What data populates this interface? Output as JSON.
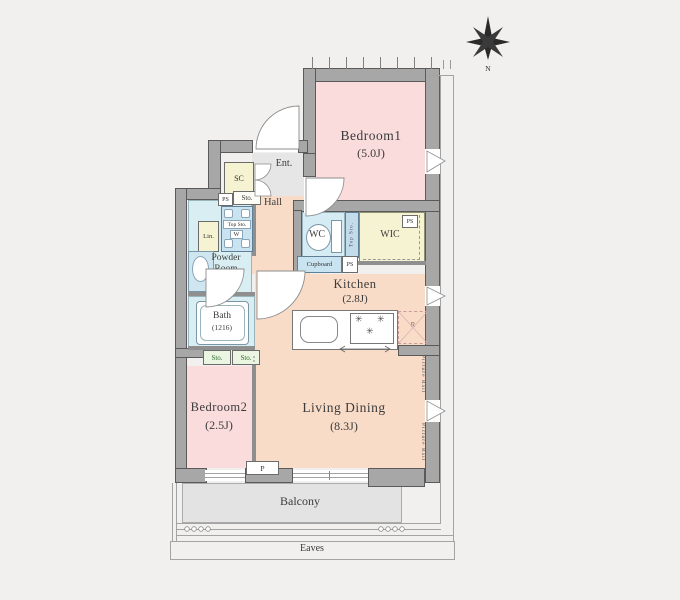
{
  "compass": {
    "north": "N"
  },
  "rooms": {
    "bedroom1": {
      "name": "Bedroom1",
      "size": "(5.0J)"
    },
    "bedroom2": {
      "name": "Bedroom2",
      "size": "(2.5J)"
    },
    "living_dining": {
      "name": "Living Dining",
      "size": "(8.3J)"
    },
    "kitchen": {
      "name": "Kitchen",
      "size": "(2.8J)"
    },
    "hall": {
      "name": "Hall"
    },
    "entrance": {
      "name": "Ent."
    },
    "wc": {
      "name": "WC"
    },
    "wic": {
      "name": "WIC"
    },
    "powder_room": {
      "line1": "Powder",
      "line2": "Room"
    },
    "bath": {
      "name": "Bath",
      "size": "(1216)"
    },
    "balcony": {
      "name": "Balcony"
    },
    "eaves": {
      "name": "Eaves"
    }
  },
  "fixtures": {
    "sc": "SC",
    "lin": "Lin.",
    "top_sto": "Top Sto.",
    "washer_w": "W",
    "sto": "Sto.",
    "cupboard": "Cupboard",
    "refrigerator_r": "R",
    "pillar_p": "P",
    "ps": "PS",
    "picture_rail": "Picture Rail"
  },
  "colors": {
    "wall": "#a7a7a7",
    "room_pink": "#fadcdc",
    "room_peach": "#f9dcc8",
    "room_cyan": "#d9eef2",
    "room_yellow": "#f6f3d3",
    "storage_green": "#eaf5e2",
    "fixture_blue": "#c9e3f0",
    "floor_gray": "#e6e6e6",
    "balcony_gray": "#e3e3e3"
  }
}
